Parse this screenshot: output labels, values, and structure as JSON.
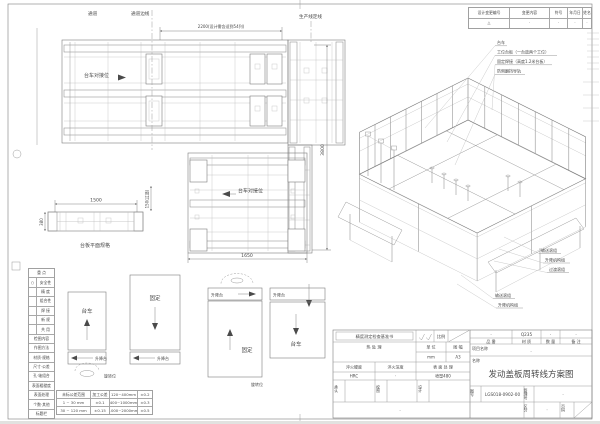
{
  "revision_table": {
    "headers": [
      "设计变更编号",
      "变更内容",
      "符号",
      "年月日",
      "姓名"
    ],
    "row": [
      "△",
      "·",
      "·",
      "·",
      "·"
    ]
  },
  "plan": {
    "aisle": "通道",
    "aisle_edge": "通道边线",
    "production_line": "生产线定线",
    "dim_width": "2200(设计需含适到54列)",
    "dim_height": "3800",
    "dim_lower": "1650",
    "dim_aisle": "150(过道)",
    "dock_upper": "台车对接位",
    "dock_lower": "台车对接位",
    "side_dim_w": "1500",
    "side_dim_h": "380",
    "side_caption": "台板平面规格"
  },
  "iso_callouts": {
    "top": [
      "台车",
      "工位台板（一台放两个工位）",
      "固定焊接（高度1.2米台板）",
      "防侧翻挡导轨"
    ],
    "right": [
      "输送滚组",
      "升降机构组",
      "过渡滚组"
    ],
    "lower": [
      "输送滚组",
      "升降机构组"
    ]
  },
  "flow": {
    "pos1": {
      "label": "台车",
      "sub": "升降台",
      "note": "旋转位"
    },
    "pos2": {
      "label": "固定",
      "sub": "升降台"
    },
    "pos3": {
      "label": "固定",
      "sub": "升降台",
      "note": "旋转位"
    },
    "pos4": {
      "label": "台车",
      "sub": "升降台"
    }
  },
  "check_table": {
    "header1": "重  点",
    "rows1": [
      [
        "○",
        "安全性"
      ],
      [
        "",
        "精 度"
      ],
      [
        "",
        "组合性"
      ],
      [
        "",
        "焊 接"
      ],
      [
        "",
        "新 规"
      ],
      [
        "",
        "共 用"
      ]
    ],
    "header2": "检图内容",
    "rows2": [
      "作图方法",
      "材质·规格",
      "尺寸·公差",
      "孔·轴组合",
      "表面粗糙度",
      "表面处理",
      "个数·其他",
      "标题栏"
    ]
  },
  "tolerance_table": {
    "rows": [
      [
        "未标公差范围",
        "加工公差",
        "120~400mm",
        "±0.2"
      ],
      [
        "1 ~ 30 mm",
        "±0.1",
        "400~1000mm",
        "±0.3"
      ],
      [
        "30 ~ 120 mm",
        "±0.15",
        "1000~2000mm",
        "±0.5"
      ]
    ]
  },
  "title_block": {
    "inspection_title": "精度测定检查基准书",
    "scale_label": "比例",
    "heat_treatment": "热 处 理",
    "unit_label": "单 位",
    "unit_value": "mm",
    "sheet_label": "图 幅",
    "sheet_value": "A3",
    "quench_hardness_label": "淬火硬度",
    "quench_hardness_value": "HRC",
    "quench_depth_label": "淬火深度",
    "quench_depth_value": "·",
    "surface_label": "表 面 处 理",
    "surface_value": "喷塑480",
    "approve_label": "承认",
    "check_label": "校图",
    "design_label": "设计",
    "bottom_note": "·",
    "part_label": "品 番",
    "part_value": "·",
    "material_label": "材 质",
    "material_value": "Q235",
    "qty_label": "数 量",
    "qty_value": "·",
    "remark_label": "备 注",
    "remark_value": "·",
    "project_label": "项目名称",
    "project_value": "·",
    "name_label": "名称",
    "name_value": "发动盖板周转线方案图",
    "dwg_label": "图号",
    "dwg_value": "LGS018-0902-00",
    "mgmt_label": "管理号",
    "mgmt_value": "·",
    "class_label": "区分",
    "class_value": "·",
    "page_label": "页码"
  }
}
